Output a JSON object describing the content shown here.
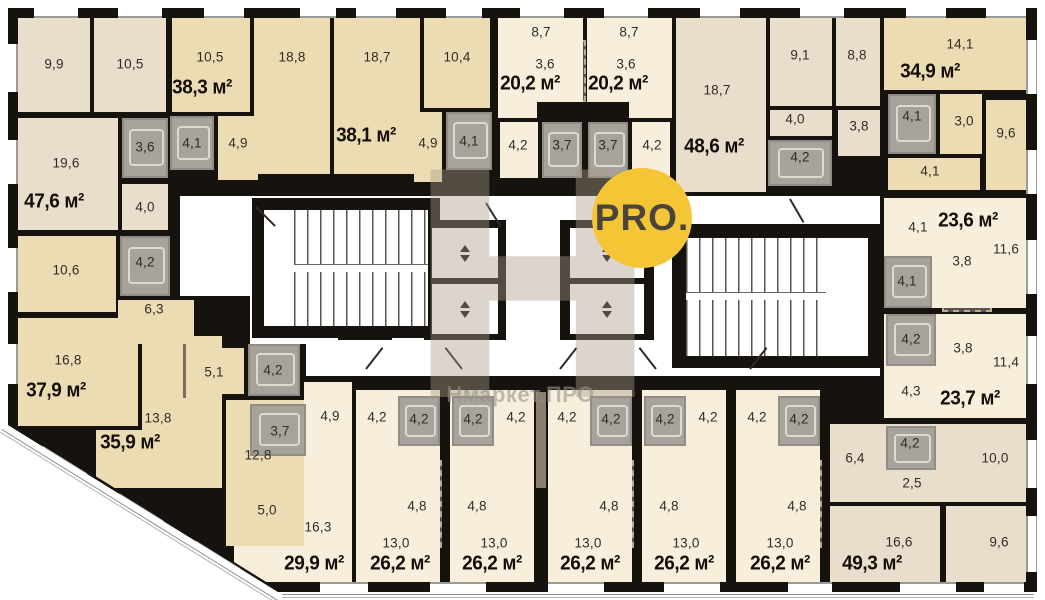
{
  "watermark": {
    "monogram": "Н",
    "logo": "PRO.",
    "brand": "Нмаркет.ПРО",
    "accent_color": "#f4c636"
  },
  "units": {
    "u476": {
      "label": "47,6 м²",
      "rooms": {
        "room1": "9,9",
        "room2": "10,5",
        "living": "19,6",
        "bath": "3,6",
        "hall": "4,0"
      }
    },
    "u383": {
      "label": "38,3 м²",
      "rooms": {
        "room1": "10,5",
        "room2": "18,8",
        "bath": "4,1",
        "hall": "4,9"
      }
    },
    "u381": {
      "label": "38,1 м²",
      "rooms": {
        "room1": "18,7",
        "room2": "10,4",
        "hall": "4,9",
        "bath": "4,1"
      }
    },
    "u202a": {
      "label": "20,2 м²",
      "rooms": {
        "room": "8,7",
        "kitchen": "3,6",
        "hall": "4,2",
        "bath": "3,7"
      }
    },
    "u202b": {
      "label": "20,2 м²",
      "rooms": {
        "room": "8,7",
        "kitchen": "3,6",
        "hall": "4,2",
        "bath": "3,7"
      }
    },
    "u486": {
      "label": "48,6 м²",
      "rooms": {
        "living": "18,7",
        "room1": "9,1",
        "room2": "8,8",
        "hall": "4,0",
        "hall2": "3,8",
        "bath": "4,2"
      }
    },
    "u349": {
      "label": "34,9 м²",
      "rooms": {
        "living": "14,1",
        "bath": "4,1",
        "hall": "3,0",
        "room": "9,6",
        "hall2": "4,1"
      }
    },
    "u236": {
      "label": "23,6 м²",
      "rooms": {
        "hall": "4,1",
        "kitchen": "3,8",
        "room": "11,6",
        "bath": "4,1"
      }
    },
    "u237": {
      "label": "23,7 м²",
      "rooms": {
        "bath": "4,2",
        "kitchen": "3,8",
        "room": "11,4",
        "hall": "4,3"
      }
    },
    "u493": {
      "label": "49,3 м²",
      "rooms": {
        "hall": "6,4",
        "bath": "4,2",
        "hall2": "2,5",
        "room1": "10,0",
        "living": "16,6",
        "room2": "9,6"
      }
    },
    "u379": {
      "label": "37,9 м²",
      "rooms": {
        "room": "10,6",
        "bath": "4,2",
        "hall": "6,3",
        "living": "16,8"
      }
    },
    "u359": {
      "label": "35,9 м²",
      "rooms": {
        "hall": "5,1",
        "bath": "4,2",
        "room1": "13,8",
        "room2": "12,8"
      }
    },
    "u299": {
      "label": "29,9 м²",
      "rooms": {
        "bath": "3,7",
        "hall": "4,9",
        "kitchen": "5,0",
        "living": "16,3"
      }
    },
    "s1": {
      "label": "26,2 м²",
      "rooms": {
        "hall": "4,2",
        "bath": "4,2",
        "kitchen": "4,8",
        "room": "13,0"
      }
    },
    "s2": {
      "label": "26,2 м²",
      "rooms": {
        "hall": "4,2",
        "bath": "4,2",
        "kitchen": "4,8",
        "room": "13,0"
      }
    },
    "s3": {
      "label": "26,2 м²",
      "rooms": {
        "hall": "4,2",
        "bath": "4,2",
        "kitchen": "4,8",
        "room": "13,0"
      }
    },
    "s4": {
      "label": "26,2 м²",
      "rooms": {
        "hall": "4,2",
        "bath": "4,2",
        "kitchen": "4,8",
        "room": "13,0"
      }
    },
    "s5": {
      "label": "26,2 м²",
      "rooms": {
        "hall": "4,2",
        "bath": "4,2",
        "kitchen": "4,8",
        "room": "13,0"
      }
    }
  }
}
